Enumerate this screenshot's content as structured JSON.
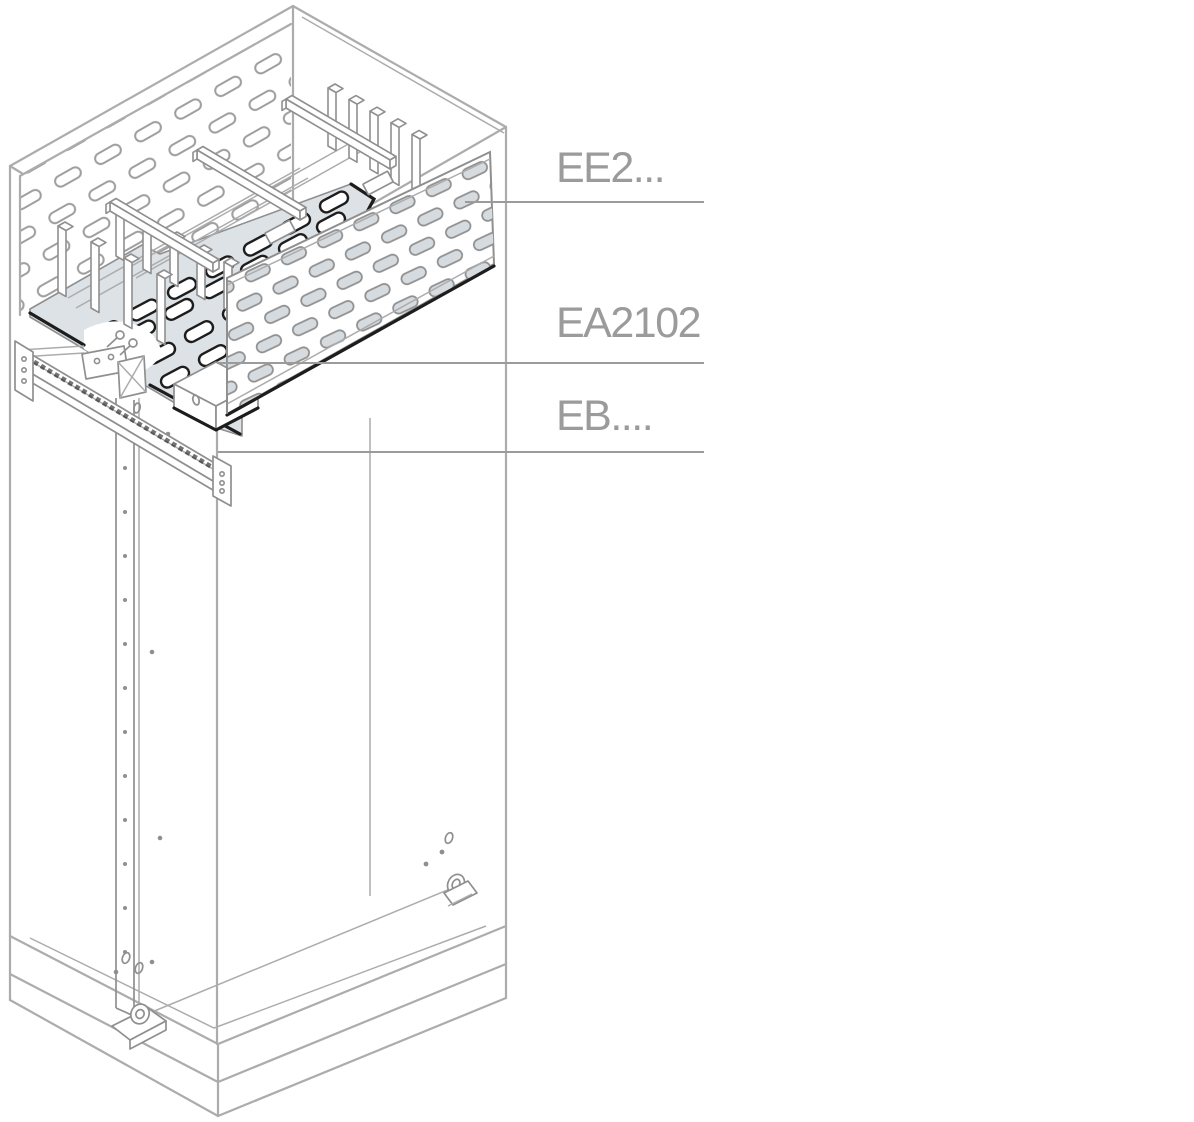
{
  "labels": {
    "ee2": "EE2...",
    "ea2102": "EA2102",
    "eb": "EB...."
  },
  "colors": {
    "line": "#acacac",
    "part": "#8f8f8f",
    "dark": "#1d1d1d",
    "plate": "#dde2e6",
    "slot": "#d6dbdf",
    "label": "#9b9b9b"
  }
}
